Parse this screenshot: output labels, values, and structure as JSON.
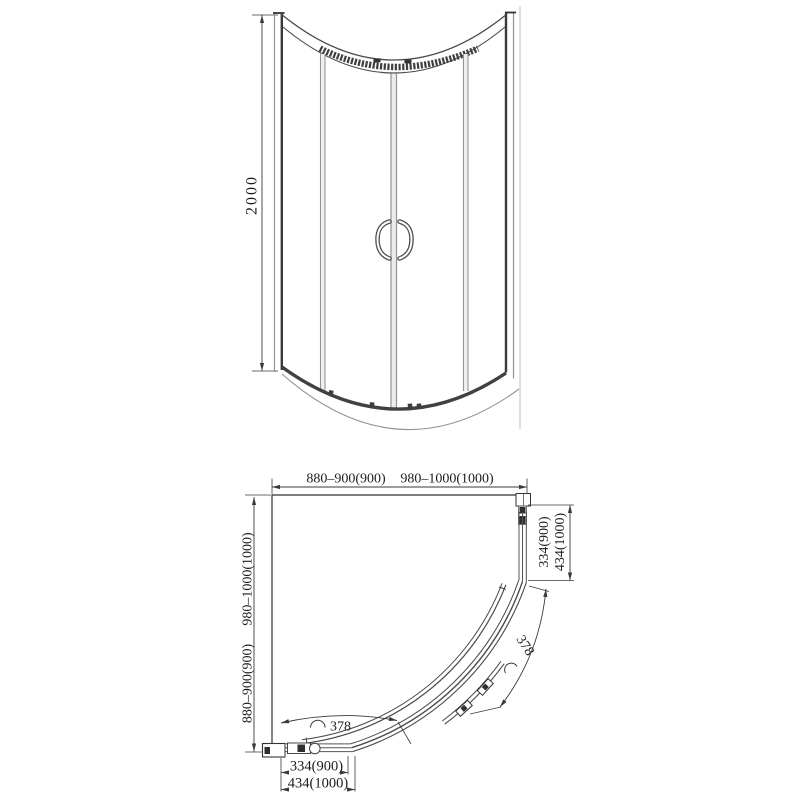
{
  "title": "Quadrant shower enclosure technical drawing",
  "colors": {
    "background": "#ffffff",
    "line": "#3c3c3c",
    "line_gray": "#949494",
    "line_faint": "#cccccc",
    "text": "#1c1c1c"
  },
  "elevation": {
    "height": "2000"
  },
  "plan": {
    "top_width_1": "880–900(900)",
    "top_width_2": "980–1000(1000)",
    "left_depth_1": "980–1000(1000)",
    "left_depth_2": "880–900(900)",
    "right_entry_1": "334(900)",
    "right_entry_2": "434(1000)",
    "bottom_entry_1": "334(900)",
    "bottom_entry_2": "434(1000)",
    "door_arc_width_right": "378",
    "door_arc_width_bottom": "378"
  }
}
